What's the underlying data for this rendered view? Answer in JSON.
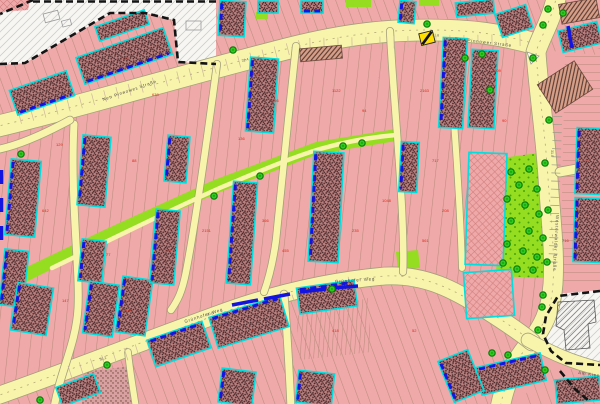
{
  "map": {
    "type": "cadastral-city-map",
    "colors": {
      "parcel_pink": "#efa9a9",
      "parcel_line": "#b98c7c",
      "street_fill": "#f8f4ab",
      "street_casing": "#a39f7c",
      "street_centerline": "#b3a878",
      "building_base": "#bb8181",
      "building_speck": "#462626",
      "building_hatch_bg": "#d79e88",
      "building_hatch_line": "#54382f",
      "cyan_outline": "#00dfdf",
      "blue_dash": "#1414e0",
      "green_fill": "#94dd20",
      "green_dot": "#46a50a",
      "tree_fill": "#2ecb1e",
      "tree_ring": "#0c7c0c",
      "white_area": "#f7f6f3",
      "gray_hatch": "#aeacac",
      "black_dash": "#141414",
      "red_number": "#e02616",
      "gray_number": "#6b655c",
      "label_color": "#55504a",
      "crosshatch_line": "#d07d7d",
      "transformer_yellow": "#ffdf00"
    },
    "street_names": {
      "top": "Neu Pinnower Straße",
      "bottom": "Grünhofer Weg",
      "right": "Westerwalder Straße",
      "se": "Am Kiesteich"
    },
    "street_labels": [
      {
        "ref": "top",
        "x": 103,
        "y": 101,
        "rot": -19
      },
      {
        "ref": "top",
        "x": 455,
        "y": 40,
        "rot": 7
      },
      {
        "ref": "bottom",
        "x": 185,
        "y": 323,
        "rot": -18
      },
      {
        "ref": "bottom",
        "x": 335,
        "y": 283,
        "rot": -4
      },
      {
        "ref": "right",
        "x": 556,
        "y": 215,
        "rot": 93
      },
      {
        "ref": "se",
        "x": 578,
        "y": 374,
        "rot": 8
      }
    ],
    "gray_numbers": [
      {
        "t": "32.4",
        "x": 242,
        "y": 62,
        "rot": -15
      },
      {
        "t": "31.8",
        "x": 432,
        "y": 36,
        "rot": 4
      },
      {
        "t": "30.6",
        "x": 207,
        "y": 316,
        "rot": -17
      },
      {
        "t": "31.0",
        "x": 551,
        "y": 150,
        "rot": 90
      },
      {
        "t": "30.2",
        "x": 100,
        "y": 361,
        "rot": -20
      }
    ],
    "red_numbers": [
      {
        "t": "2157",
        "x": 120,
        "y": 60
      },
      {
        "t": "638",
        "x": 152,
        "y": 96
      },
      {
        "t": "214",
        "x": 252,
        "y": 76
      },
      {
        "t": "356",
        "x": 272,
        "y": 102
      },
      {
        "t": "1122",
        "x": 332,
        "y": 92
      },
      {
        "t": "94",
        "x": 362,
        "y": 112
      },
      {
        "t": "2163",
        "x": 420,
        "y": 92
      },
      {
        "t": "717",
        "x": 432,
        "y": 162
      },
      {
        "t": "1048",
        "x": 382,
        "y": 202
      },
      {
        "t": "235",
        "x": 352,
        "y": 232
      },
      {
        "t": "366",
        "x": 262,
        "y": 222
      },
      {
        "t": "2151",
        "x": 202,
        "y": 232
      },
      {
        "t": "88",
        "x": 132,
        "y": 162
      },
      {
        "t": "129",
        "x": 56,
        "y": 146
      },
      {
        "t": "642",
        "x": 42,
        "y": 212
      },
      {
        "t": "77",
        "x": 106,
        "y": 256
      },
      {
        "t": "1310",
        "x": 162,
        "y": 252
      },
      {
        "t": "455",
        "x": 282,
        "y": 252
      },
      {
        "t": "208",
        "x": 442,
        "y": 212
      },
      {
        "t": "561",
        "x": 422,
        "y": 242
      },
      {
        "t": "90",
        "x": 502,
        "y": 122
      },
      {
        "t": "334",
        "x": 582,
        "y": 162
      },
      {
        "t": "147",
        "x": 62,
        "y": 302
      },
      {
        "t": "2209",
        "x": 122,
        "y": 312
      },
      {
        "t": "63",
        "x": 252,
        "y": 332
      },
      {
        "t": "418",
        "x": 332,
        "y": 332
      },
      {
        "t": "52",
        "x": 412,
        "y": 332
      },
      {
        "t": "716",
        "x": 562,
        "y": 242
      },
      {
        "t": "2209",
        "x": 492,
        "y": 72
      },
      {
        "t": "136",
        "x": 238,
        "y": 140
      }
    ],
    "streets": [
      {
        "id": "top-street",
        "d": "M -6,127 C 60,112 180,76 290,48 C 350,33 390,30 430,30 C 470,30 500,34 536,44",
        "w": 21,
        "center": true
      },
      {
        "id": "right-street",
        "d": "M 557,-6 C 552,20 540,38 536,52 C 538,86 545,130 548,178 C 551,222 555,252 553,284 C 551,312 542,328 530,343 C 516,360 506,378 500,408",
        "w": 19,
        "center": true
      },
      {
        "id": "bottom-street",
        "d": "M -6,397 C 60,374 160,335 230,310 C 290,289 340,280 385,276 C 425,274 455,290 486,310 C 505,322 520,332 532,342",
        "w": 17,
        "center": true
      },
      {
        "id": "se-branch-street",
        "d": "M 528,340 C 550,352 570,362 604,370",
        "w": 13
      },
      {
        "id": "east-lane",
        "d": "M 560,172 L 604,164",
        "w": 9
      },
      {
        "id": "lane-a",
        "d": "M 74,124 C 70,200 80,268 78,308 C 76,344 60,372 54,408",
        "w": 7
      },
      {
        "id": "lane-b",
        "d": "M 217,64 C 207,140 196,220 186,272 C 182,292 178,300 171,310",
        "w": 6.5
      },
      {
        "id": "lane-c",
        "d": "M 296,46 C 289,110 282,180 276,240 C 273,262 269,278 264,292",
        "w": 6.5
      },
      {
        "id": "lane-d",
        "d": "M 390,31 C 393,90 399,150 402,210 C 403,235 404,256 403,272",
        "w": 6.5
      },
      {
        "id": "lane-e",
        "d": "M 449,58 C 455,130 460,200 462,268",
        "w": 6
      },
      {
        "id": "lane-top-left",
        "d": "M 0,149 C 22,144 46,133 70,120",
        "w": 7
      },
      {
        "id": "lane-bottom-mid",
        "d": "M 284,294 C 287,330 289,366 291,408",
        "w": 7
      },
      {
        "id": "lane-bottom-left",
        "d": "M 128,352 C 130,372 133,388 136,408",
        "w": 6
      },
      {
        "id": "park-footpath",
        "d": "M 52,268 C 110,240 170,210 222,187 C 258,172 290,158 320,149 C 348,141 372,137 396,135",
        "w": 4.5,
        "noCasing": true
      }
    ],
    "parcel_regions": [
      {
        "pts": "0,0 600,0 600,55 540,50 420,26 300,44 150,82 0,128",
        "pat": "plA"
      },
      {
        "pts": "0,132 150,84 300,46 420,28 540,52 552,160 556,270 540,330 480,306 400,272 330,278 220,310 60,368 0,392",
        "pat": "plB"
      },
      {
        "pts": "0,396 60,372 220,314 330,282 400,276 470,306 520,338 505,404 0,404",
        "pat": "plC"
      },
      {
        "pts": "565,55 600,48 600,285 560,288",
        "pat": "plD"
      },
      {
        "pts": "296,316 368,298 372,352 300,360",
        "pat": "plE"
      },
      {
        "pts": "540,370 600,368 600,404 520,404",
        "pat": "plC"
      }
    ],
    "green_areas": [
      {
        "id": "green-corridor",
        "pts": "14,288 110,240 220,192 318,154 396,141 396,129 316,142 214,180 104,230 8,276",
        "pat": "flat"
      },
      {
        "id": "park",
        "pts": "502,158 546,152 550,240 546,278 496,276 499,206",
        "pat": "dots"
      },
      {
        "id": "green-top-1",
        "pts": "346,0 371,0 371,7 346,7",
        "pat": "flat"
      },
      {
        "id": "green-top-2",
        "pts": "419,0 439,0 439,6 419,6",
        "pat": "flat"
      },
      {
        "id": "green-top-3",
        "pts": "256,12 268,12 268,19 256,19",
        "pat": "flat"
      },
      {
        "id": "green-mid",
        "pts": "396,252 418,250 420,268 398,270",
        "pat": "flat"
      }
    ],
    "white_areas": [
      {
        "id": "nw-open-area",
        "pts": "0,13 33,0 216,0 216,64 178,62 174,20 145,13 110,14 25,63 0,65"
      },
      {
        "id": "se-open-area",
        "pts": "556,294 600,290 600,368 566,364 551,350 543,334 546,314"
      }
    ],
    "sketch_buildings": [
      [
        44,
        12,
        15,
        9,
        -15
      ],
      [
        62,
        20,
        9,
        6,
        -15
      ],
      [
        186,
        21,
        15,
        9,
        0
      ]
    ],
    "se_building_pts": "558,302 594,300 596,322 588,324 590,348 566,350 564,330 556,326",
    "corner_block_pts": "0,0 30,0 28,10 0,12",
    "crosshatch_blocks": [
      [
        467,
        153,
        38,
        112,
        2
      ],
      [
        465,
        271,
        48,
        46,
        -4
      ]
    ],
    "allotment_region": "84,372 132,366 136,404 82,404",
    "blocks": [
      [
        12,
        80,
        60,
        26,
        -19,
        "B",
        "s"
      ],
      [
        78,
        42,
        92,
        28,
        -19,
        "B",
        "s"
      ],
      [
        96,
        18,
        52,
        15,
        -19,
        null,
        "s"
      ],
      [
        219,
        1,
        26,
        35,
        3,
        "L",
        "s"
      ],
      [
        258,
        1,
        20,
        12,
        0,
        null,
        "s"
      ],
      [
        301,
        1,
        22,
        12,
        0,
        "B",
        "s"
      ],
      [
        399,
        1,
        16,
        22,
        5,
        "L",
        "s"
      ],
      [
        456,
        1,
        38,
        14,
        -6,
        null,
        "s"
      ],
      [
        498,
        9,
        32,
        24,
        -18,
        null,
        "s"
      ],
      [
        560,
        1,
        38,
        20,
        -10,
        null,
        "h"
      ],
      [
        560,
        26,
        40,
        22,
        -14,
        null,
        "s"
      ],
      [
        300,
        47,
        42,
        13,
        -5,
        null,
        "h"
      ],
      [
        8,
        160,
        30,
        76,
        5,
        "L",
        "s"
      ],
      [
        2,
        250,
        24,
        56,
        6,
        "L",
        "s"
      ],
      [
        14,
        285,
        36,
        48,
        9,
        "L",
        "s"
      ],
      [
        80,
        136,
        28,
        70,
        5,
        "L",
        "s"
      ],
      [
        80,
        240,
        24,
        42,
        6,
        "L",
        "s"
      ],
      [
        86,
        283,
        30,
        52,
        8,
        "L",
        "s"
      ],
      [
        119,
        278,
        30,
        56,
        8,
        "L",
        "s"
      ],
      [
        166,
        136,
        22,
        46,
        5,
        "L",
        "s"
      ],
      [
        153,
        210,
        24,
        74,
        5,
        "L",
        "s"
      ],
      [
        230,
        182,
        24,
        102,
        4,
        "L",
        "s"
      ],
      [
        248,
        58,
        28,
        74,
        4,
        "L",
        "s"
      ],
      [
        311,
        152,
        30,
        110,
        3,
        "L",
        "s"
      ],
      [
        441,
        38,
        24,
        90,
        3,
        "L",
        "s"
      ],
      [
        470,
        50,
        26,
        78,
        3,
        null,
        "s"
      ],
      [
        400,
        142,
        18,
        50,
        3,
        "L",
        "s"
      ],
      [
        576,
        128,
        26,
        66,
        2,
        "L",
        "s"
      ],
      [
        574,
        198,
        28,
        64,
        2,
        "L",
        "s"
      ],
      [
        543,
        70,
        44,
        34,
        -33,
        null,
        "h"
      ],
      [
        212,
        306,
        74,
        32,
        -17,
        "T",
        "s"
      ],
      [
        150,
        330,
        58,
        28,
        -19,
        "T",
        "s"
      ],
      [
        298,
        284,
        58,
        26,
        -8,
        "T",
        "s"
      ],
      [
        220,
        370,
        34,
        34,
        7,
        "L",
        "s"
      ],
      [
        297,
        372,
        36,
        32,
        6,
        "L",
        "s"
      ],
      [
        478,
        360,
        66,
        28,
        -13,
        "T",
        "s"
      ],
      [
        445,
        354,
        32,
        44,
        -22,
        "L",
        "s"
      ],
      [
        556,
        378,
        44,
        24,
        -5,
        null,
        "s"
      ],
      [
        58,
        380,
        40,
        20,
        -20,
        null,
        "s"
      ]
    ],
    "black_dashed_paths": [
      "M 33,0 L 0,14",
      "M 33,1.5 L 216,1.5",
      "M 0,64 L 25,63 L 110,13 L 145,13 L 174,20 L 178,62 L 216,64",
      "M 600,291 L 558,296 L 546,316 L 543,334 L 551,351 L 566,363 L 600,365",
      "M 560,371 L 575,389 L 588,400"
    ],
    "blue_street_dashes": [
      [
        232,
        305,
        258,
        300
      ],
      [
        264,
        299,
        290,
        294
      ],
      [
        300,
        292,
        326,
        289
      ],
      [
        332,
        288,
        358,
        286
      ],
      [
        568,
        26,
        572,
        48
      ],
      [
        1.5,
        170,
        1.5,
        184
      ],
      [
        1.5,
        198,
        1.5,
        212
      ],
      [
        1.5,
        226,
        1.5,
        240
      ]
    ],
    "tick_rows": [
      {
        "x1": 559,
        "y1": 76,
        "x2": 553,
        "y2": 262,
        "n": 24,
        "len": 9,
        "c": "#9a9a85"
      },
      {
        "x1": 70,
        "y1": 372,
        "x2": 350,
        "y2": 283,
        "n": 26,
        "len": 13,
        "c": "#c9b79b"
      },
      {
        "x1": 20,
        "y1": 118,
        "x2": 300,
        "y2": 46,
        "n": 24,
        "len": 12,
        "c": "#c9b79b"
      },
      {
        "x1": 310,
        "y1": 44,
        "x2": 520,
        "y2": 40,
        "n": 16,
        "len": 12,
        "c": "#c9b79b"
      }
    ],
    "trees": [
      [
        233,
        50
      ],
      [
        427,
        24
      ],
      [
        465,
        58
      ],
      [
        482,
        54
      ],
      [
        533,
        58
      ],
      [
        548,
        9
      ],
      [
        543,
        25
      ],
      [
        563,
        13
      ],
      [
        490,
        90
      ],
      [
        549,
        120
      ],
      [
        545,
        163
      ],
      [
        548,
        210
      ],
      [
        543,
        238
      ],
      [
        547,
        262
      ],
      [
        533,
        270
      ],
      [
        543,
        295
      ],
      [
        542,
        307
      ],
      [
        538,
        330
      ],
      [
        545,
        370
      ],
      [
        492,
        353
      ],
      [
        508,
        355
      ],
      [
        40,
        400
      ],
      [
        107,
        365
      ],
      [
        332,
        289
      ],
      [
        21,
        154
      ],
      [
        214,
        196
      ],
      [
        260,
        176
      ],
      [
        343,
        146
      ],
      [
        362,
        143
      ],
      [
        511,
        172
      ],
      [
        529,
        169
      ],
      [
        519,
        185
      ],
      [
        537,
        189
      ],
      [
        507,
        199
      ],
      [
        525,
        205
      ],
      [
        539,
        214
      ],
      [
        511,
        221
      ],
      [
        529,
        231
      ],
      [
        507,
        244
      ],
      [
        523,
        251
      ],
      [
        537,
        257
      ],
      [
        503,
        263
      ],
      [
        517,
        269
      ]
    ],
    "traffic_island": "527,52 539,56 531,64",
    "transformer": {
      "x": 420,
      "y": 32,
      "w": 14,
      "h": 12,
      "rot": -14
    }
  }
}
